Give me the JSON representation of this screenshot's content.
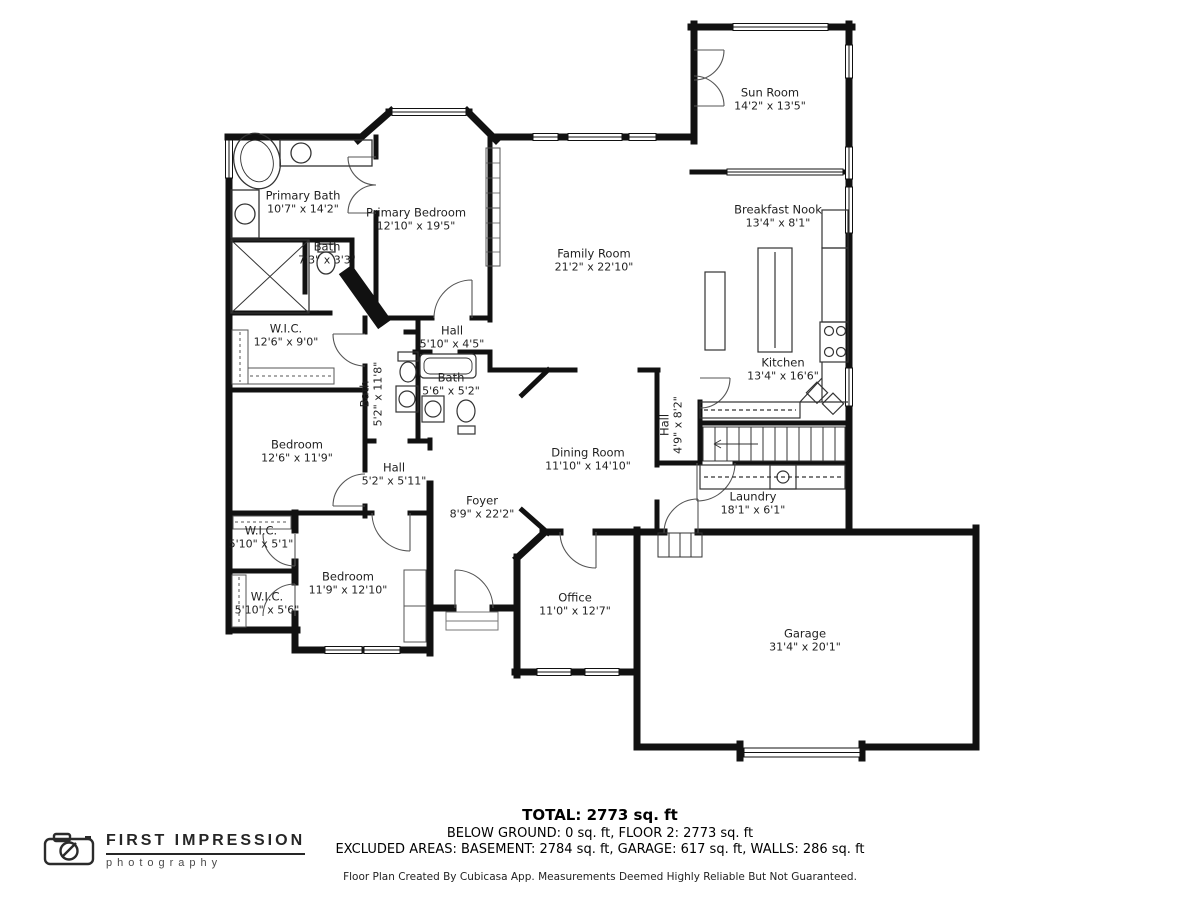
{
  "rooms": [
    {
      "name": "Sun Room",
      "dims": "14'2\" x 13'5\""
    },
    {
      "name": "Breakfast Nook",
      "dims": "13'4\" x 8'1\""
    },
    {
      "name": "Family Room",
      "dims": "21'2\" x 22'10\""
    },
    {
      "name": "Kitchen",
      "dims": "13'4\" x 16'6\""
    },
    {
      "name": "Primary Bath",
      "dims": "10'7\" x 14'2\""
    },
    {
      "name": "Primary Bedroom",
      "dims": "12'10\" x 19'5\""
    },
    {
      "name": "Bath",
      "dims": "7'3\" x 3'3\""
    },
    {
      "name": "Hall",
      "dims": "5'10\" x 4'5\""
    },
    {
      "name": "W.I.C.",
      "dims": "12'6\" x 9'0\""
    },
    {
      "name": "Bath",
      "dims": "5'2\" x 11'8\""
    },
    {
      "name": "Bath",
      "dims": "5'6\" x 5'2\""
    },
    {
      "name": "Bedroom",
      "dims": "12'6\" x 11'9\""
    },
    {
      "name": "Hall",
      "dims": "5'2\" x 5'11\""
    },
    {
      "name": "Foyer",
      "dims": "8'9\" x 22'2\""
    },
    {
      "name": "Dining Room",
      "dims": "11'10\" x 14'10\""
    },
    {
      "name": "Hall",
      "dims": "4'9\" x 8'2\""
    },
    {
      "name": "Laundry",
      "dims": "18'1\" x 6'1\""
    },
    {
      "name": "W.I.C.",
      "dims": "5'10\" x 5'1\""
    },
    {
      "name": "Bedroom",
      "dims": "11'9\" x 12'10\""
    },
    {
      "name": "W.I.C.",
      "dims": "5'10\" x 5'6\""
    },
    {
      "name": "Office",
      "dims": "11'0\" x 12'7\""
    },
    {
      "name": "Garage",
      "dims": "31'4\" x 20'1\""
    }
  ],
  "footer": {
    "total": "TOTAL: 2773 sq. ft",
    "line2": "BELOW GROUND: 0 sq. ft, FLOOR 2: 2773 sq. ft",
    "line3": "EXCLUDED AREAS: BASEMENT: 2784 sq. ft, GARAGE: 617 sq. ft, WALLS: 286 sq. ft",
    "disclaimer": "Floor Plan Created By Cubicasa App. Measurements Deemed Highly Reliable But Not Guaranteed."
  },
  "logo": {
    "brand": "FIRST IMPRESSION",
    "sub": "photography"
  },
  "colors": {
    "wall": "#111111",
    "fixture": "#3a3a3a",
    "label": "#1f1f1f"
  }
}
